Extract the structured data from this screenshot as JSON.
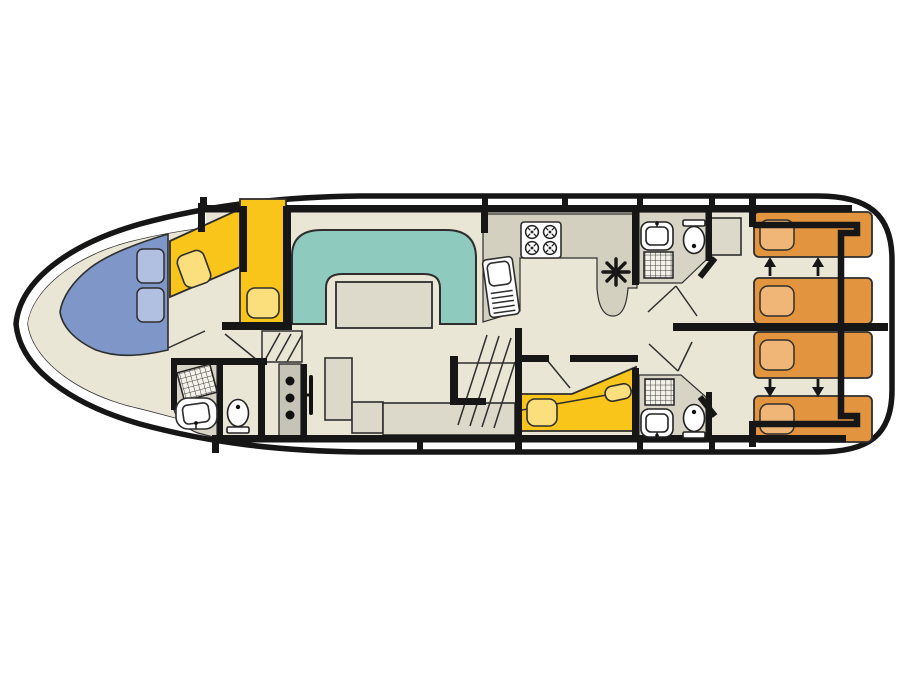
{
  "diagram": {
    "kind": "houseboat-deck-plan-top-view",
    "orientation": "bow-left-stern-right"
  },
  "colors": {
    "wall": "#161616",
    "line": "#2e2e2e",
    "hull_bg": "#ffffff",
    "floor": "#e9e6d6",
    "wet": "#d7d4c5",
    "counter": "#d3d0c0",
    "furniture": "#dcd9ca",
    "sofa": "#8ecabe",
    "table": "#dddacc",
    "bow_panel": "#7e97c8",
    "bow_cushion": "#b1bfe0",
    "bed_yellow": "#f9c51a",
    "pillow_yellow": "#fbdf7c",
    "bed_orange": "#e3943f",
    "pillow_orange": "#efb678",
    "console": "#c6c4b6"
  },
  "rooms": {
    "bow_cabin": {
      "beds": 2,
      "cushioned_seat": true
    },
    "bow_bathroom": {
      "fixtures": [
        "shower",
        "washbasin",
        "toilet"
      ]
    },
    "saloon": {
      "seating": "u-shaped-sofa-with-table",
      "helm_console": true,
      "steps": 2
    },
    "galley": {
      "fixtures": [
        "four-burner-stove",
        "sink-with-drainer"
      ],
      "vent_symbol": true
    },
    "mid_cabin": {
      "beds": 1
    },
    "mid_bathroom_top": {
      "fixtures": [
        "washbasin",
        "toilet",
        "shower"
      ]
    },
    "mid_bathroom_bottom": {
      "fixtures": [
        "shower",
        "washbasin",
        "toilet"
      ]
    },
    "stern_cabins": {
      "count": 2,
      "single_beds_each": 2,
      "slide_together_arrows": 4,
      "wardrobe": 1
    }
  }
}
